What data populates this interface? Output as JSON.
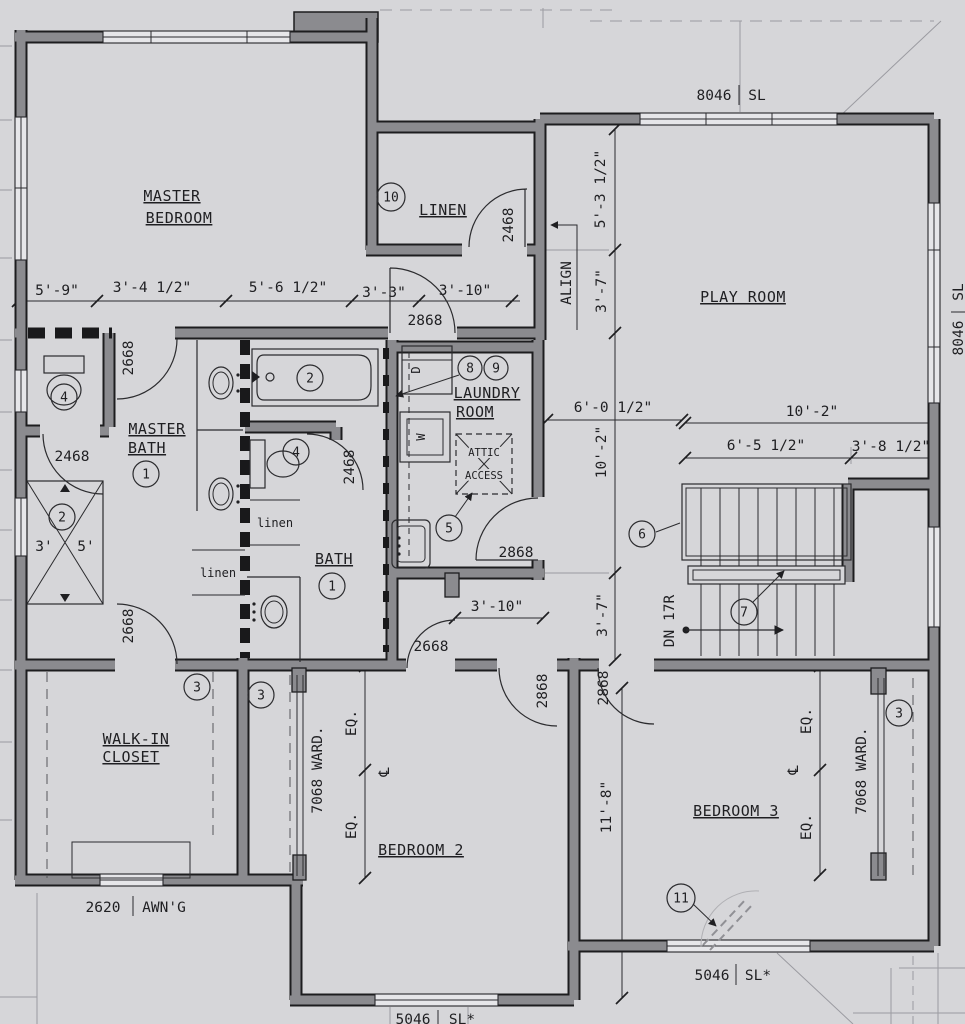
{
  "plan": {
    "rooms": {
      "mb1": "MASTER",
      "mb2": "BEDROOM",
      "play": "PLAY ROOM",
      "linen": "LINEN",
      "mbath1": "MASTER",
      "mbath2": "BATH",
      "laundry1": "LAUNDRY",
      "laundry2": "ROOM",
      "bath": "BATH",
      "wic1": "WALK-IN",
      "wic2": "CLOSET",
      "bed2": "BEDROOM 2",
      "bed3": "BEDROOM 3"
    },
    "windows": {
      "top": {
        "size": "8046",
        "type": "SL"
      },
      "right": {
        "size": "8046",
        "type": "SL"
      },
      "bed3": {
        "size": "5046",
        "type": "SL*"
      },
      "bed2": {
        "size": "5046",
        "type": "SL*"
      },
      "closet": {
        "size": "2620",
        "type": "AWN'G"
      }
    },
    "doors": {
      "mb_entry": "2668",
      "wic": "2668",
      "bath_hall": "2668",
      "hall": "2868",
      "laundry": "2868",
      "bed2": "2868",
      "bed3": "2868",
      "linen": "2468",
      "wc1": "2468",
      "wc2": "2468"
    },
    "dims": {
      "d5_9": "5'-9\"",
      "d3_4h": "3'-4 1/2\"",
      "d5_6h": "5'-6 1/2\"",
      "d3_3": "3'-3\"",
      "d3_10a": "3'-10\"",
      "d5_3h": "5'-3 1/2\"",
      "d3_7a": "3'-7\"",
      "d6_0h": "6'-0 1/2\"",
      "d10_2v": "10'-2\"",
      "d10_2s": "10'-2\"",
      "d6_5h": "6'-5 1/2\"",
      "d3_8h": "3'-8 1/2\"",
      "d3_10b": "3'-10\"",
      "d3_7b": "3'-7\"",
      "d11_8": "11'-8\"",
      "shower_w": "3'",
      "shower_l": "5'",
      "align": "ALIGN",
      "dn": "DN 17R",
      "eq": "EQ.",
      "cl": "℄",
      "ward": "7068 WARD."
    },
    "keynotes": {
      "k1": "1",
      "k2": "2",
      "k3": "3",
      "k4": "4",
      "k5": "5",
      "k6": "6",
      "k7": "7",
      "k8": "8",
      "k9": "9",
      "k10": "10",
      "k11": "11"
    },
    "labels": {
      "attic1": "ATTIC",
      "attic2": "ACCESS",
      "linen_small": "linen",
      "dryer": "D",
      "washer": "W"
    }
  }
}
